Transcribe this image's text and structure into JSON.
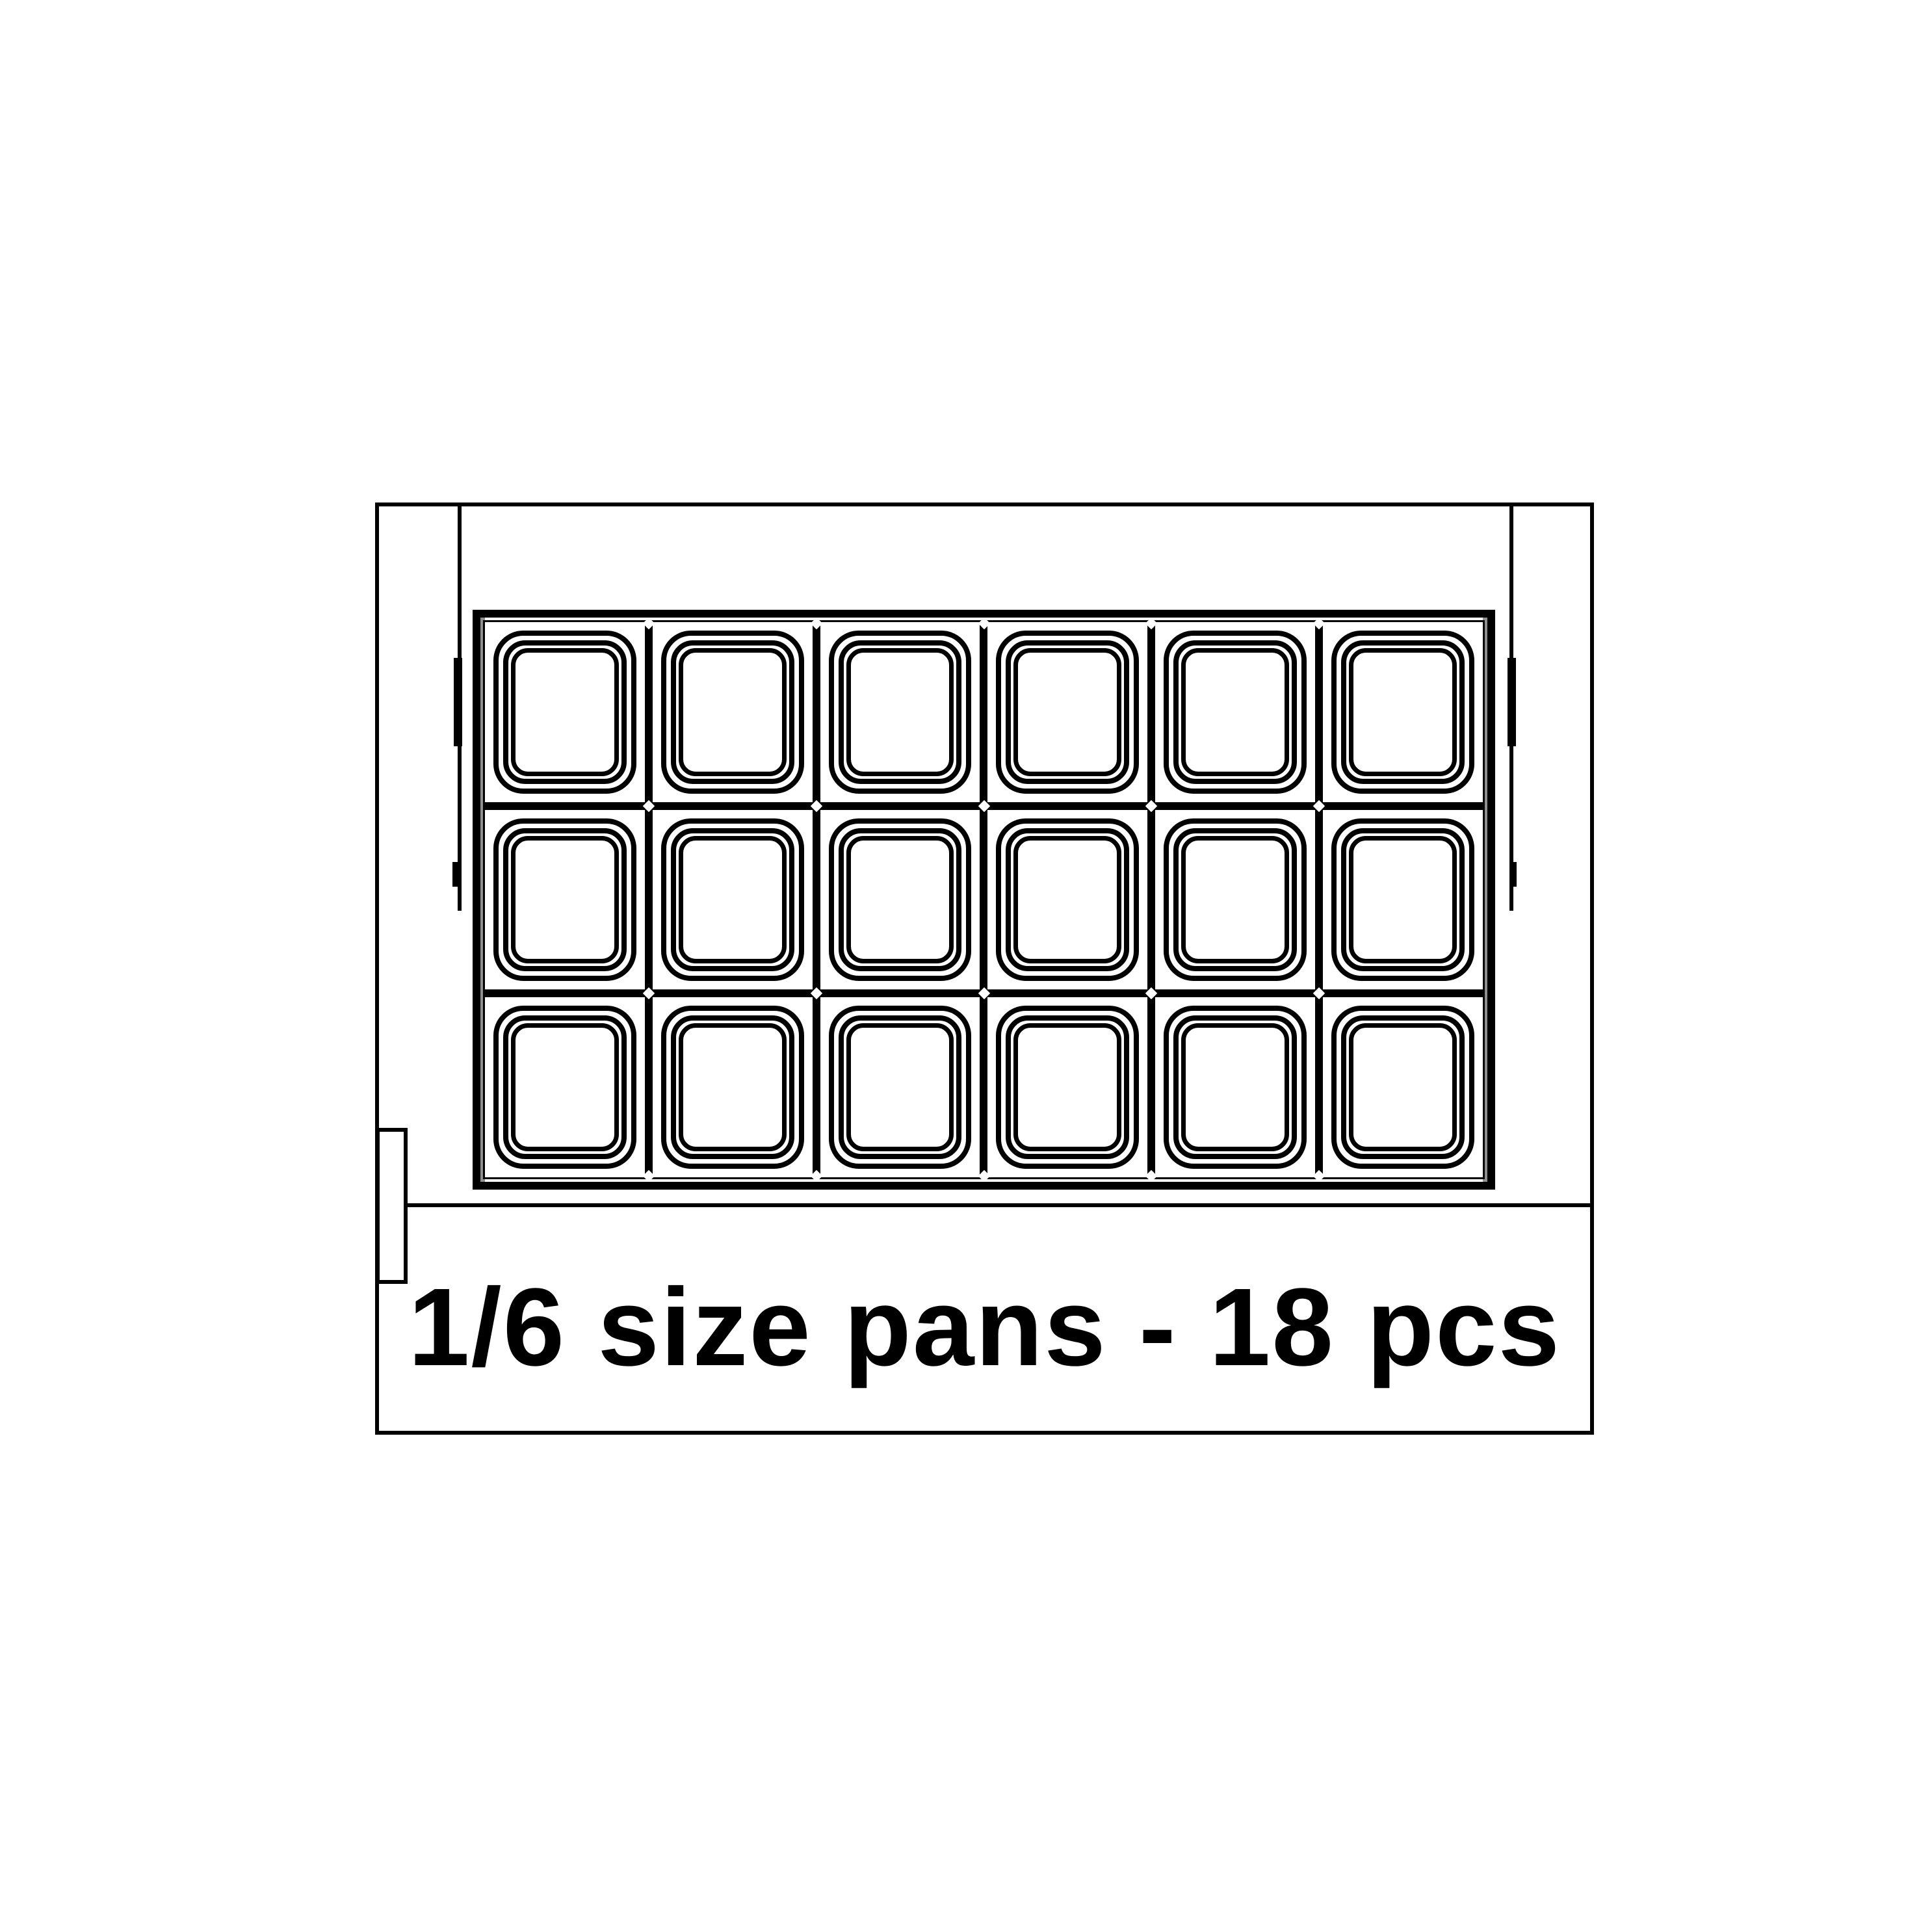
{
  "diagram": {
    "caption": "1/6 size pans - 18 pcs",
    "pan_grid": {
      "rows": 3,
      "columns": 6,
      "pan_count": 18
    },
    "colors": {
      "line": "#000000",
      "background": "#ffffff",
      "shade": "#8f8f8f"
    }
  }
}
